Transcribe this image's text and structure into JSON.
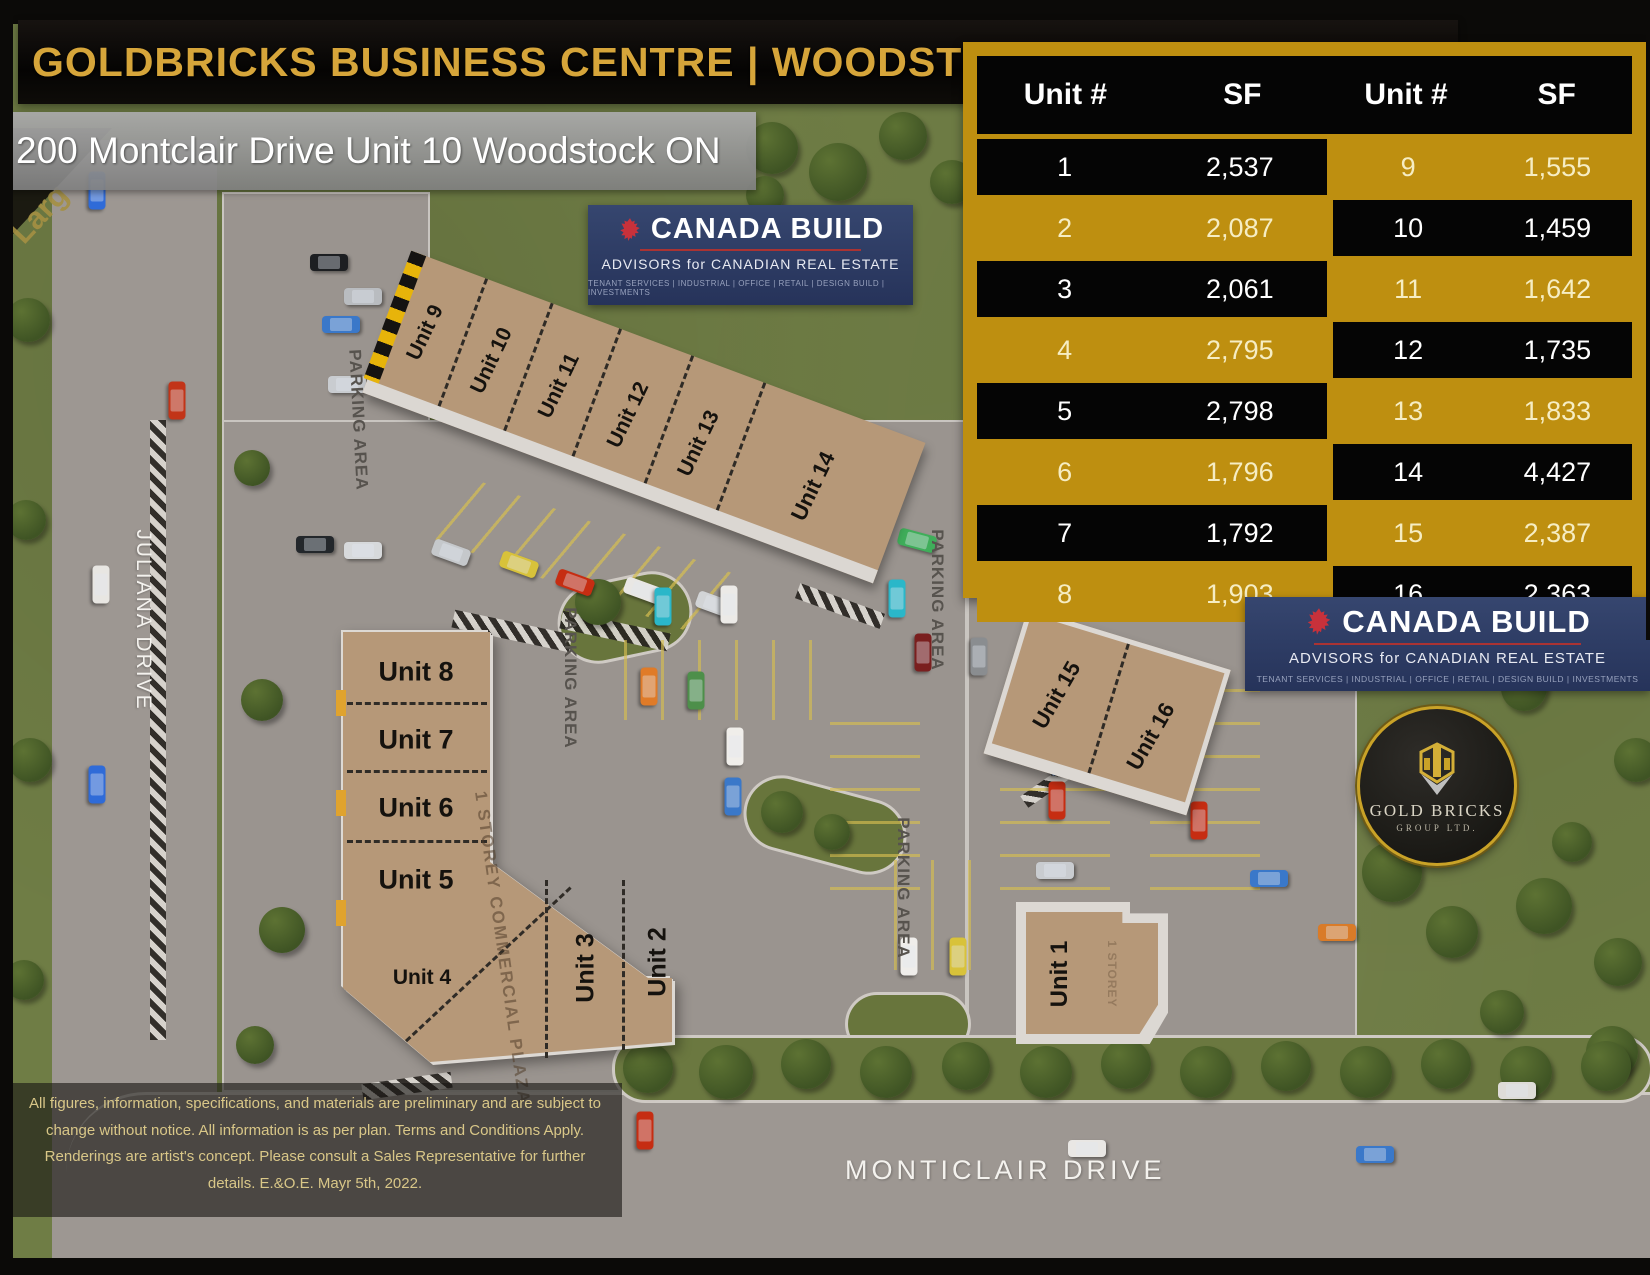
{
  "title": "GOLDBRICKS BUSINESS CENTRE | WOODSTOCK",
  "address": "200 Montclair Drive Unit 10 Woodstock ON",
  "watermark": "Larg",
  "unit_table": {
    "headers": [
      "Unit #",
      "SF",
      "Unit #",
      "SF"
    ],
    "rows": [
      {
        "lu": "1",
        "ls": "2,537",
        "ru": "9",
        "rs": "1,555"
      },
      {
        "lu": "2",
        "ls": "2,087",
        "ru": "10",
        "rs": "1,459"
      },
      {
        "lu": "3",
        "ls": "2,061",
        "ru": "11",
        "rs": "1,642"
      },
      {
        "lu": "4",
        "ls": "2,795",
        "ru": "12",
        "rs": "1,735"
      },
      {
        "lu": "5",
        "ls": "2,798",
        "ru": "13",
        "rs": "1,833"
      },
      {
        "lu": "6",
        "ls": "1,796",
        "ru": "14",
        "rs": "4,427"
      },
      {
        "lu": "7",
        "ls": "1,792",
        "ru": "15",
        "rs": "2,387"
      },
      {
        "lu": "8",
        "ls": "1,903",
        "ru": "16",
        "rs": "2,363"
      }
    ]
  },
  "canada_build": {
    "name": "CANADA BUILD",
    "tagline": "ADVISORS for CANADIAN REAL ESTATE",
    "services": "TENANT SERVICES | INDUSTRIAL | OFFICE | RETAIL | DESIGN BUILD | INVESTMENTS"
  },
  "gold_bricks": {
    "name": "GOLD BRICKS",
    "subtitle": "GROUP LTD."
  },
  "site": {
    "units": [
      "Unit 1",
      "Unit 2",
      "Unit 3",
      "Unit 4",
      "Unit 5",
      "Unit 6",
      "Unit 7",
      "Unit 8",
      "Unit 9",
      "Unit 10",
      "Unit 11",
      "Unit 12",
      "Unit 13",
      "Unit 14",
      "Unit 15",
      "Unit 16"
    ],
    "plaza_label": "1 STOREY COMMERCIAL PLAZA",
    "storey_label": "1 STOREY",
    "parking_label": "PARKING AREA",
    "street_left": "JULIANA DRIVE",
    "street_bottom": "MONTICLAIR DRIVE"
  },
  "disclaimer": "All figures, information, specifications, and materials are preliminary and are subject to change without notice. All information is as per plan. Terms and Conditions Apply. Renderings are artist's concept. Please consult a Sales Representative for further details. E.&O.E. Mayr 5th, 2022.",
  "colors": {
    "gold": "#BE8F10",
    "title_gold": "#D6A53A",
    "build_blue": "#2C3B69",
    "tan": "#B69878"
  }
}
